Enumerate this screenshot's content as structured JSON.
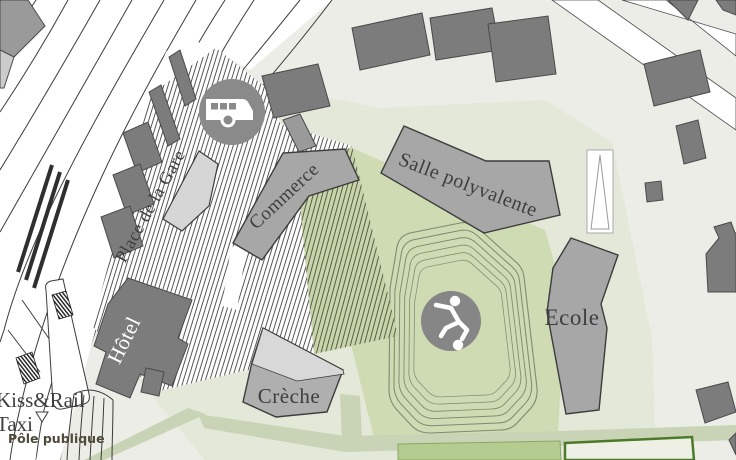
{
  "map": {
    "title": "Site plan - gare district",
    "labels": {
      "place_de_la_gare": "Place de la Gare",
      "commerce": "Commerce",
      "salle_polyvalente": "Salle polyvalente",
      "ecole": "Ecole",
      "creche": "Crèche",
      "hotel": "Hôtel",
      "kiss_rail": "Kiss&Rail",
      "taxi": "Taxi",
      "pole_publique": "Pôle publique"
    },
    "icons": [
      "bus-icon",
      "soccer-player-icon"
    ],
    "colors": {
      "background": "#ECEDE6",
      "park": "#E3E8D8",
      "lawn": "#CEDBB3",
      "hatch_green": "#C8D5A9",
      "building": "#A7A7A7",
      "building_dark": "#7C7C7C",
      "building_light": "#D6D6D6",
      "outline": "#3C3C3C",
      "icon_circle": "#8A8A8A",
      "track_line": "#7F8A72",
      "court_border": "#4C7A28",
      "green_rect": "#B4CC90",
      "path_band": "#C9D4B6",
      "label": "#3E3E3E",
      "hotel_label": "#FFFFFF"
    }
  }
}
